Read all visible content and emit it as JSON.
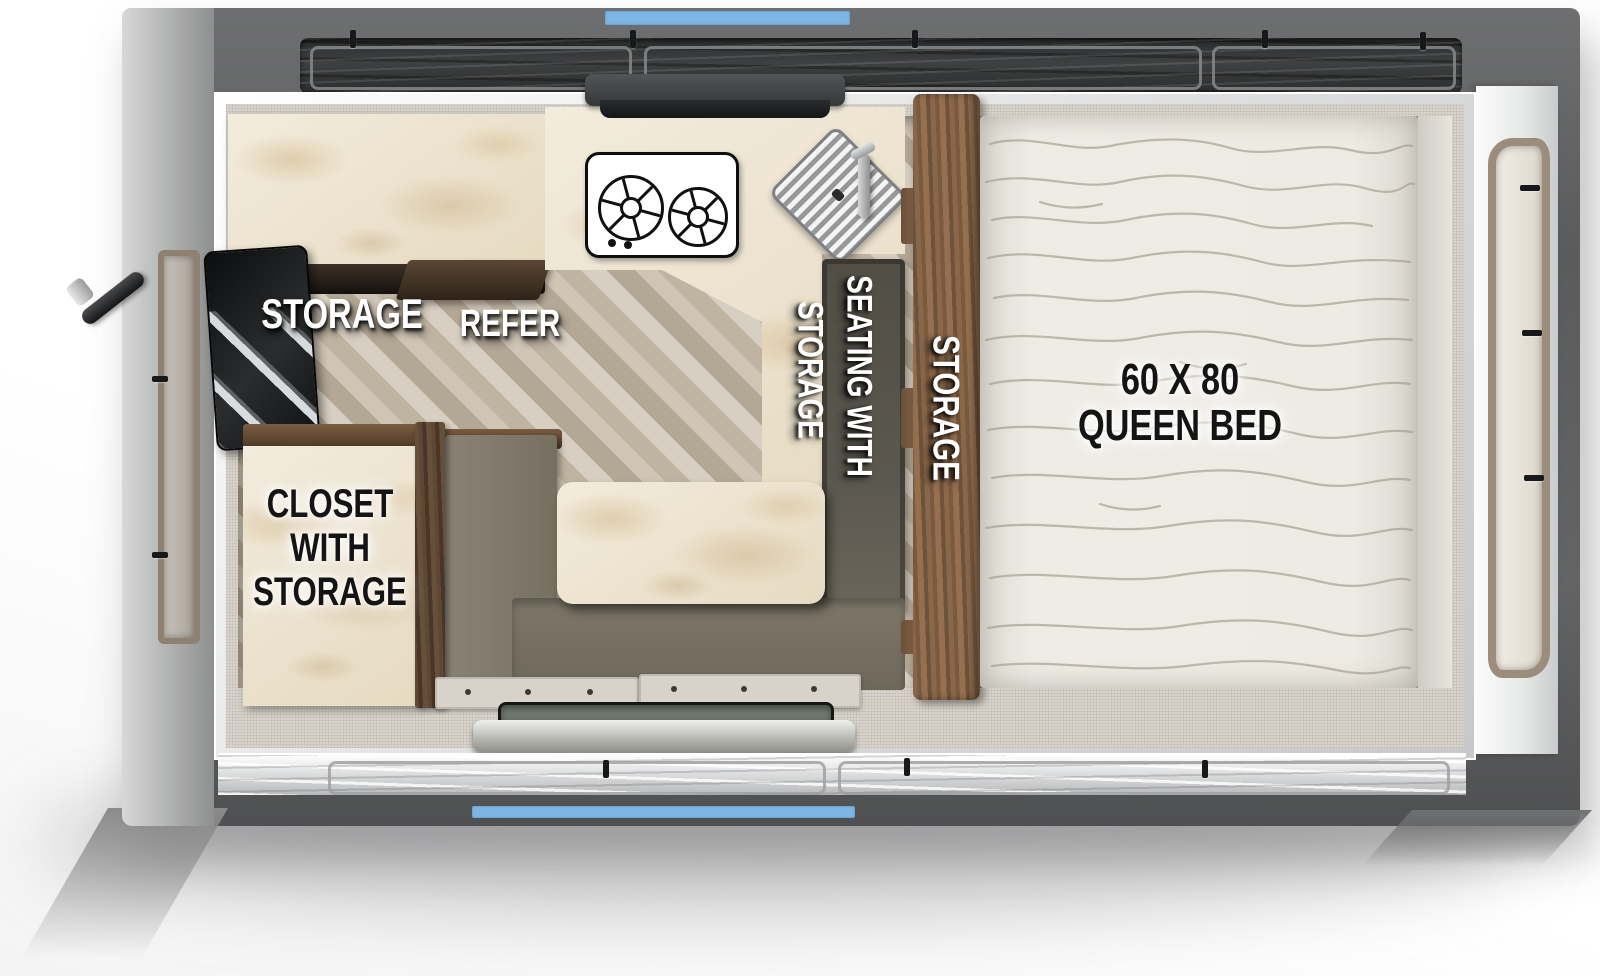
{
  "floorplan": {
    "labels": {
      "storage_cabinet": "STORAGE",
      "refrigerator": "REFER",
      "closet": {
        "line1": "CLOSET",
        "line2": "WITH",
        "line3": "STORAGE"
      },
      "seating": {
        "line1": "SEATING WITH",
        "line2": "STORAGE"
      },
      "divider_storage": "STORAGE",
      "bed": {
        "line1": "60 X 80",
        "line2": "QUEEN BED"
      }
    },
    "colors": {
      "accent_blue": "#7bb6e5",
      "body_gray": "#616263",
      "marble": "#ece2cd",
      "wood_brown": "#7d5c41",
      "seat_olive": "#7c7568",
      "seat_dark": "#54514a",
      "mattress": "#edeae3",
      "label_white": "#ffffff",
      "label_black": "#141414"
    }
  }
}
